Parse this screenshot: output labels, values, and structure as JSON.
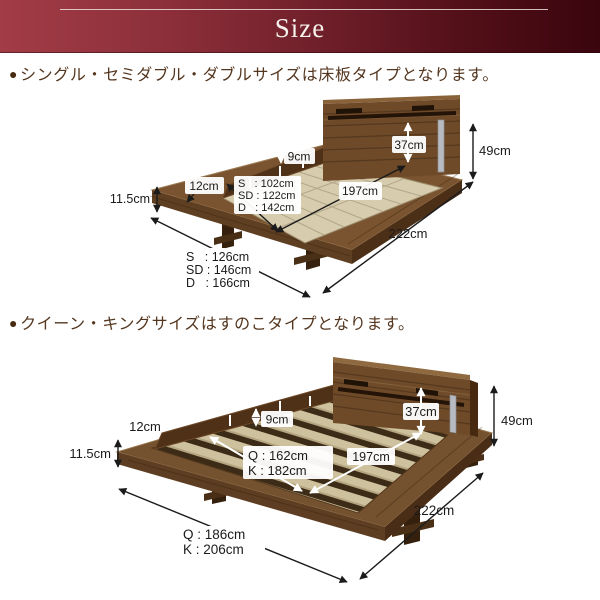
{
  "banner": {
    "title": "Size"
  },
  "section_floorboard": {
    "bullet": "●",
    "heading": "シングル・セミダブル・ダブルサイズは床板タイプとなります。",
    "dims": {
      "headboard_height": "37cm",
      "total_height": "49cm",
      "rail_height": "9cm",
      "stage_depth": "12cm",
      "frame_thickness": "11.5cm",
      "sleeping_length": "197cm",
      "total_length": "222cm",
      "inner_widths": [
        "S   : 102cm",
        "SD : 122cm",
        "D   : 142cm"
      ],
      "outer_widths": [
        "S   : 126cm",
        "SD : 146cm",
        "D   : 166cm"
      ]
    }
  },
  "section_slatted": {
    "bullet": "●",
    "heading": "クイーン・キングサイズはすのこタイプとなります。",
    "dims": {
      "headboard_height": "37cm",
      "total_height": "49cm",
      "rail_height": "9cm",
      "stage_depth": "12cm",
      "frame_thickness": "11.5cm",
      "sleeping_length": "197cm",
      "total_length": "222cm",
      "inner_widths": [
        "Q : 162cm",
        "K : 182cm"
      ],
      "outer_widths": [
        "Q : 186cm",
        "K : 206cm"
      ]
    }
  }
}
